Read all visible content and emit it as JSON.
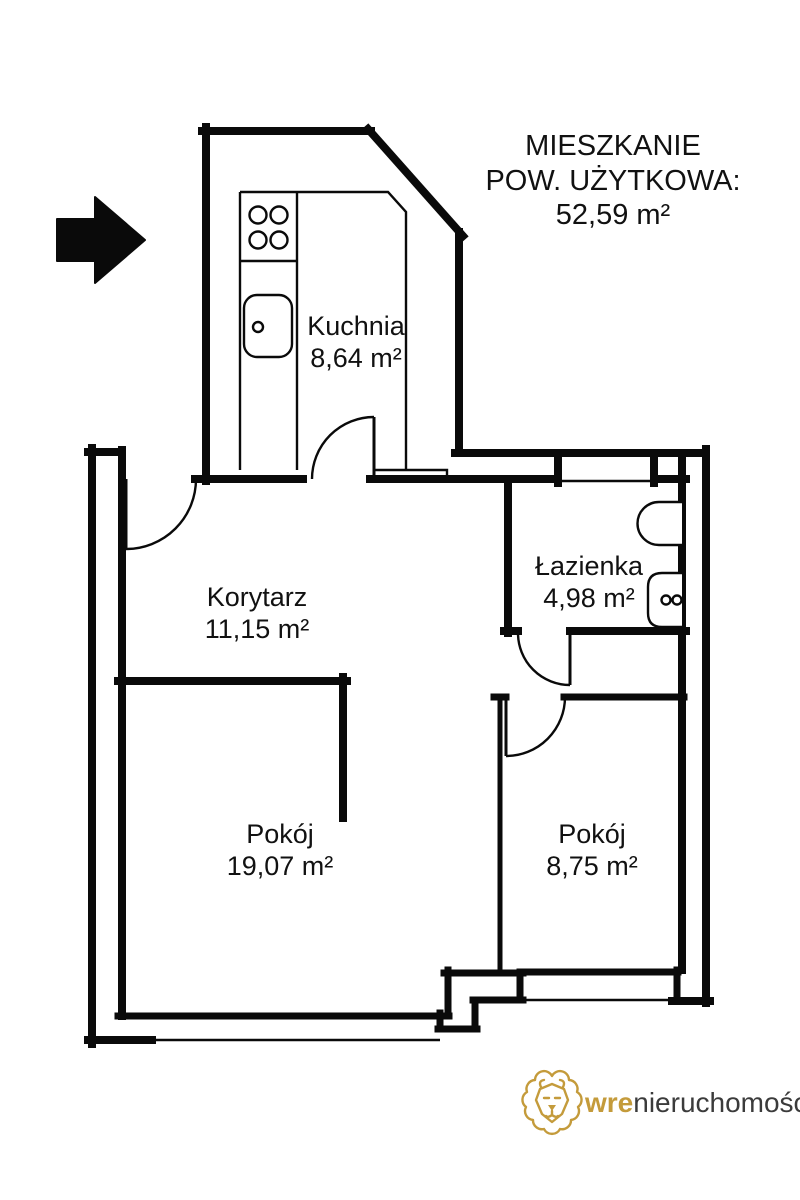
{
  "title": {
    "line1": "MIESZKANIE",
    "line2": "POW. UŻYTKOWA:",
    "line3": "52,59 m²"
  },
  "rooms": [
    {
      "name": "Kuchnia",
      "area": "8,64 m²"
    },
    {
      "name": "Korytarz",
      "area": "11,15 m²"
    },
    {
      "name": "Łazienka",
      "area": "4,98 m²"
    },
    {
      "name": "Pokój",
      "area": "19,07 m²"
    },
    {
      "name": "Pokój",
      "area": "8,75 m²"
    }
  ],
  "logo": {
    "brand_bold": "wre",
    "brand_rest": "nieruchomości"
  },
  "icons": {
    "entrance_arrow": "entrance-arrow-icon",
    "stove": "stove-icon",
    "sink": "sink-icon",
    "toilet": "toilet-icon",
    "washbasin": "washbasin-icon",
    "lion": "lion-logo-icon"
  },
  "colors": {
    "wall": "#0a0a0a",
    "gold": "#c49b3b",
    "brand_text": "#3b3b3b"
  }
}
